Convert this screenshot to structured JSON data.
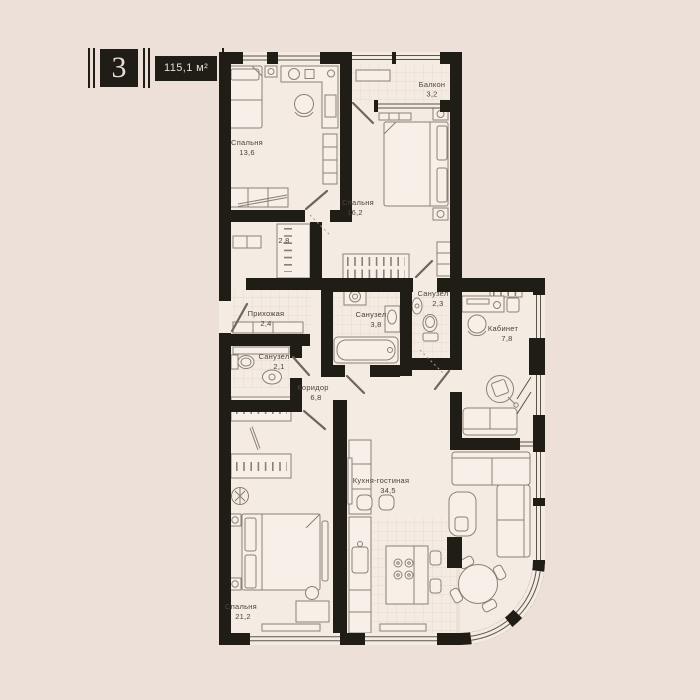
{
  "badge": {
    "number": "3",
    "total_area": "115,1 м²"
  },
  "rooms": {
    "bedroom_top": {
      "name": "Спальня",
      "area": "13,6"
    },
    "balcony": {
      "name": "Балкон",
      "area": "3,2"
    },
    "bedroom_mid": {
      "name": "Спальня",
      "area": "16,2"
    },
    "closet": {
      "name": "",
      "area": "2,8"
    },
    "hallway": {
      "name": "Прихожая",
      "area": "2,4"
    },
    "bath_small": {
      "name": "Санузел",
      "area": "2,1"
    },
    "bath_main": {
      "name": "Санузел",
      "area": "3,8"
    },
    "bath_guest": {
      "name": "Санузел",
      "area": "2,3"
    },
    "office": {
      "name": "Кабинет",
      "area": "7,8"
    },
    "corridor": {
      "name": "Коридор",
      "area": "6,8"
    },
    "kitchen_living": {
      "name": "Кухня-гостиная",
      "area": "34,5"
    },
    "bedroom_master": {
      "name": "Спальня",
      "area": "21,2"
    }
  },
  "colors": {
    "background": "#ECE0D8",
    "floor": "#F4EBE3",
    "wall": "#201C16",
    "line": "#8B8176",
    "text": "#4B453D",
    "badge-text": "#EADDD3",
    "glaze": "#5B544B",
    "tile": "#E2D6CC"
  }
}
